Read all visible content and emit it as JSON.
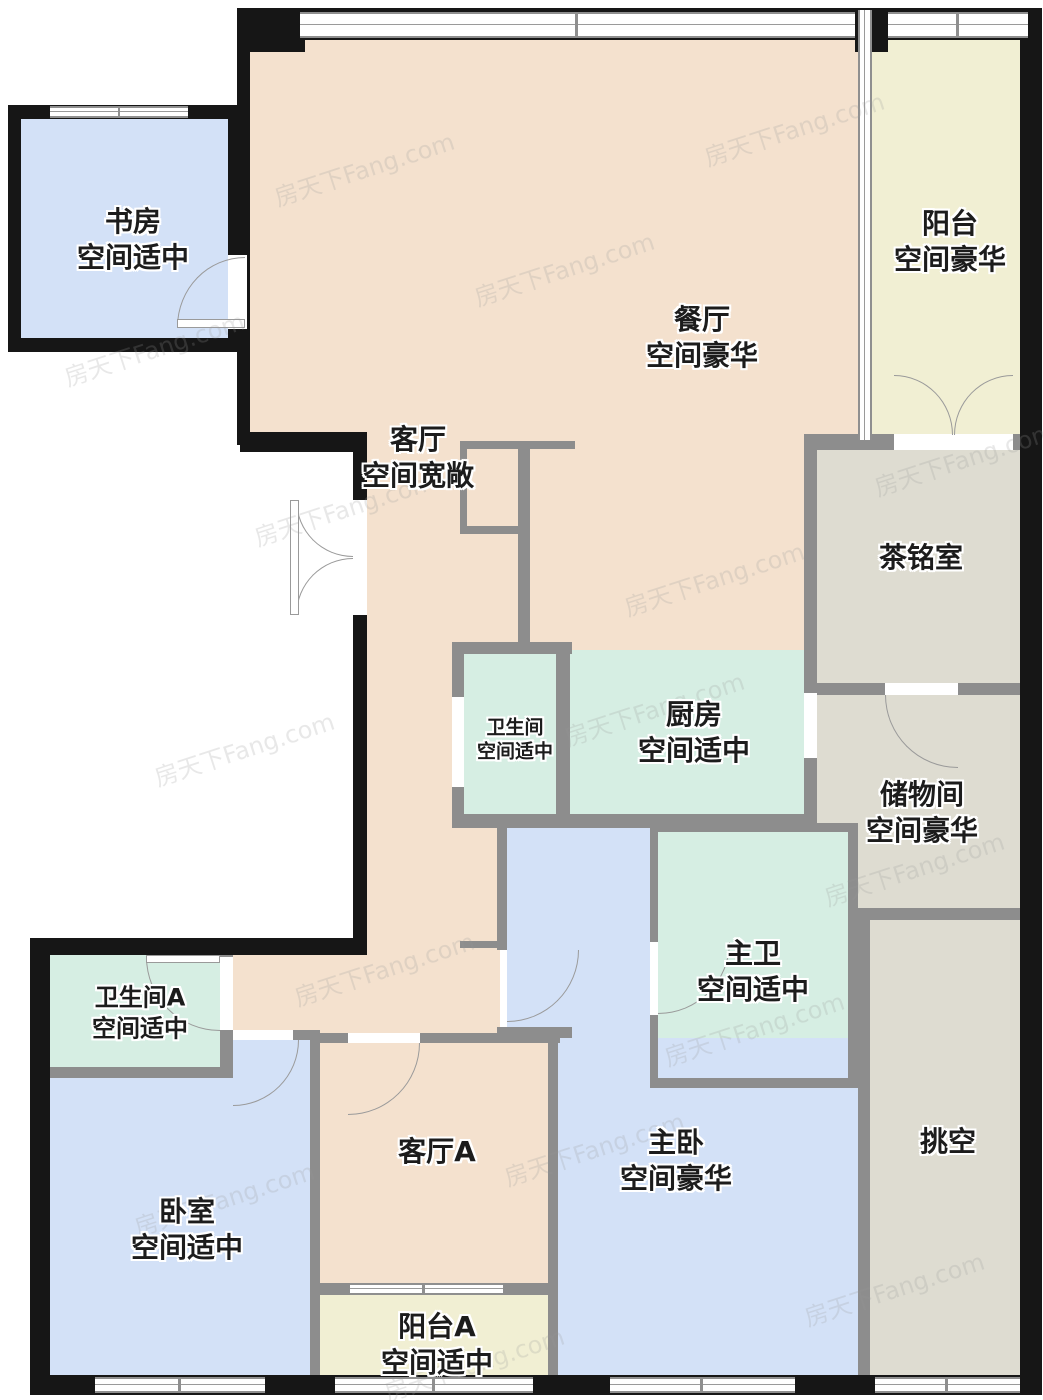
{
  "watermark": {
    "text": "房天下Fang.com"
  },
  "palette": {
    "floor_beige": "#f4e1ce",
    "floor_blue": "#d3e1f7",
    "floor_mint": "#d6eee3",
    "floor_yellow": "#f1efd3",
    "floor_graygreen": "#dedcd1",
    "wall_exterior": "#161616",
    "wall_interior": "#8d8d8d"
  },
  "rooms": [
    {
      "id": "study",
      "name": "书房",
      "size": "空间适中"
    },
    {
      "id": "dining",
      "name": "餐厅",
      "size": "空间豪华"
    },
    {
      "id": "balcony",
      "name": "阳台",
      "size": "空间豪华"
    },
    {
      "id": "living",
      "name": "客厅",
      "size": "空间宽敞"
    },
    {
      "id": "tea-room",
      "name": "茶铭室",
      "size": ""
    },
    {
      "id": "bathroom",
      "name": "卫生间",
      "size": "空间适中"
    },
    {
      "id": "kitchen",
      "name": "厨房",
      "size": "空间适中"
    },
    {
      "id": "storage",
      "name": "储物间",
      "size": "空间豪华"
    },
    {
      "id": "master-bath",
      "name": "主卫",
      "size": "空间适中"
    },
    {
      "id": "bathroom-a",
      "name": "卫生间A",
      "size": "空间适中"
    },
    {
      "id": "bedroom",
      "name": "卧室",
      "size": "空间适中"
    },
    {
      "id": "living-a",
      "name": "客厅A",
      "size": ""
    },
    {
      "id": "master-bedroom",
      "name": "主卧",
      "size": "空间豪华"
    },
    {
      "id": "void",
      "name": "挑空",
      "size": ""
    },
    {
      "id": "balcony-a",
      "name": "阳台A",
      "size": "空间适中"
    }
  ]
}
